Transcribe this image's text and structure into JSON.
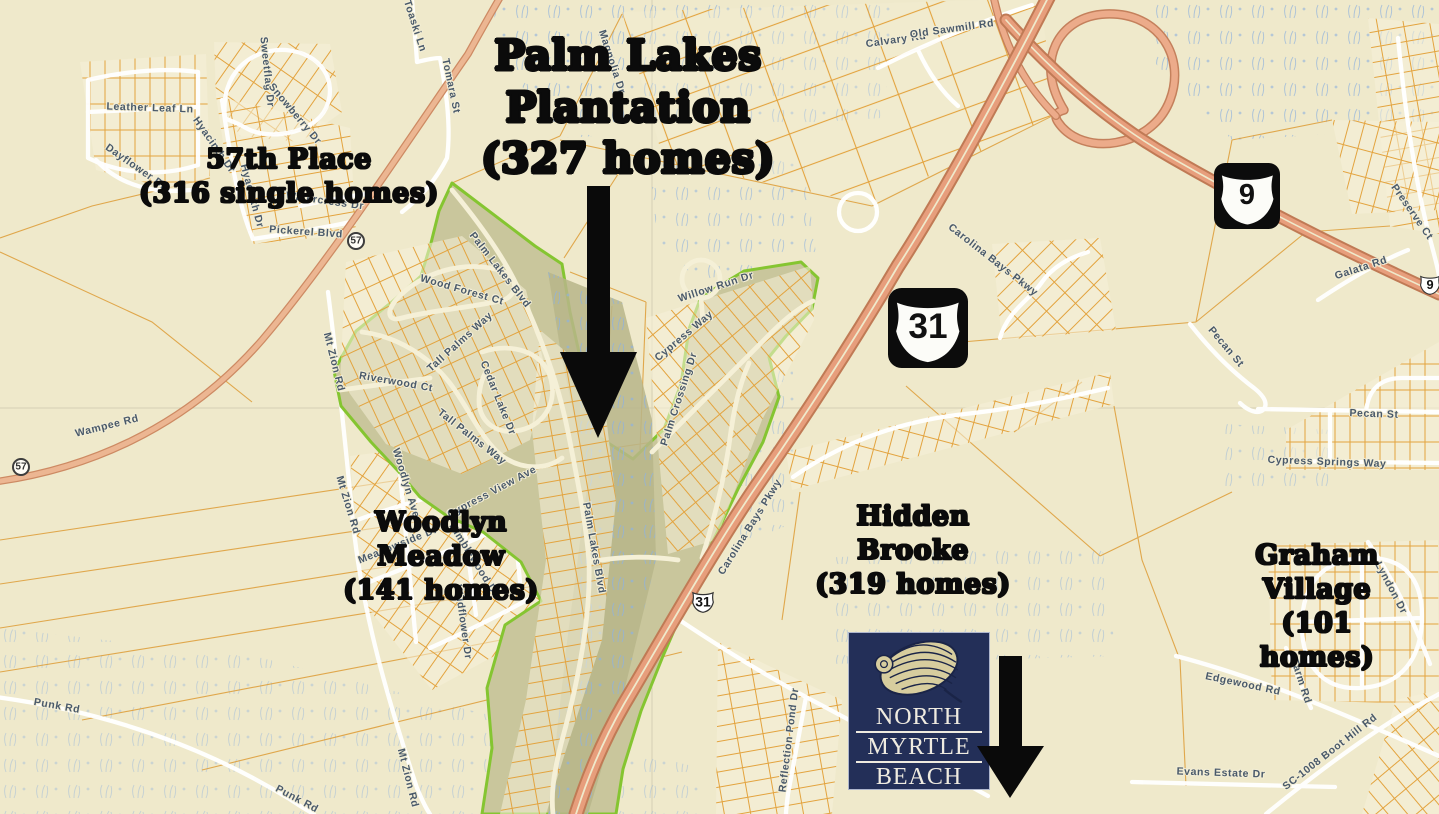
{
  "map": {
    "background_color": "#efe9cb",
    "parcel_line_color": "#dd9b35",
    "highway_color": "#e79e7c",
    "subdivision_fill": "#c9c69c",
    "subdivision_border_color": "#85c531",
    "marsh_mark_color": "#8fb2dd",
    "annotations": [
      {
        "id": "palm-lakes-plantation",
        "lines": [
          "Palm Lakes",
          "Plantation",
          "(327 homes)"
        ],
        "x": 628,
        "y": 108,
        "size": 41
      },
      {
        "id": "57th-place",
        "lines": [
          "57th Place",
          "(316 single homes)"
        ],
        "x": 289,
        "y": 177,
        "size": 27
      },
      {
        "id": "woodlyn-meadow",
        "lines": [
          "Woodlyn",
          "Meadow",
          "(141 homes)"
        ],
        "x": 441,
        "y": 557,
        "size": 27
      },
      {
        "id": "hidden-brooke",
        "lines": [
          "Hidden",
          "Brooke",
          "(319 homes)"
        ],
        "x": 913,
        "y": 551,
        "size": 27
      },
      {
        "id": "graham-village",
        "lines": [
          "Graham",
          "Village",
          "(101 homes)"
        ],
        "x": 1317,
        "y": 607,
        "size": 27
      }
    ],
    "street_labels": [
      {
        "text": "Toaski Ln",
        "x": 415,
        "y": 26,
        "rot": 72
      },
      {
        "text": "Tomara St",
        "x": 451,
        "y": 86,
        "rot": 78
      },
      {
        "text": "Magnolia Dr",
        "x": 612,
        "y": 62,
        "rot": 72
      },
      {
        "text": "Calvary Rd",
        "x": 896,
        "y": 40,
        "rot": -8
      },
      {
        "text": "Old Sawmill Rd",
        "x": 952,
        "y": 29,
        "rot": -8
      },
      {
        "text": "Leather Leaf Ln",
        "x": 150,
        "y": 108,
        "rot": 2
      },
      {
        "text": "Dayflower Dr",
        "x": 136,
        "y": 167,
        "rot": 35
      },
      {
        "text": "Hyacinth Dr",
        "x": 214,
        "y": 145,
        "rot": 55
      },
      {
        "text": "Hyacinth Dr",
        "x": 252,
        "y": 196,
        "rot": 75
      },
      {
        "text": "Sweetflag Dr",
        "x": 267,
        "y": 72,
        "rot": 84
      },
      {
        "text": "Snowberry Dr",
        "x": 295,
        "y": 114,
        "rot": 50
      },
      {
        "text": "Watercress Dr",
        "x": 325,
        "y": 201,
        "rot": 8
      },
      {
        "text": "Pickerel Blvd",
        "x": 306,
        "y": 232,
        "rot": 4
      },
      {
        "text": "Wampee Rd",
        "x": 107,
        "y": 426,
        "rot": -14
      },
      {
        "text": "Mt Zion Rd",
        "x": 334,
        "y": 362,
        "rot": 76
      },
      {
        "text": "Mt Zion Rd",
        "x": 348,
        "y": 505,
        "rot": 73
      },
      {
        "text": "Mt Zion Rd",
        "x": 408,
        "y": 778,
        "rot": 76
      },
      {
        "text": "Punk Rd",
        "x": 57,
        "y": 706,
        "rot": 10
      },
      {
        "text": "Punk Rd",
        "x": 297,
        "y": 799,
        "rot": 28
      },
      {
        "text": "Woodlyn Ave",
        "x": 406,
        "y": 483,
        "rot": 73
      },
      {
        "text": "Meadowside Dr",
        "x": 398,
        "y": 545,
        "rot": -22
      },
      {
        "text": "Cypress View Ave",
        "x": 492,
        "y": 492,
        "rot": -28
      },
      {
        "text": "Kimblewood Dr",
        "x": 474,
        "y": 560,
        "rot": 58
      },
      {
        "text": "Wildflower Dr",
        "x": 463,
        "y": 622,
        "rot": 82
      },
      {
        "text": "Palm Lakes Blvd",
        "x": 500,
        "y": 270,
        "rot": 52
      },
      {
        "text": "Palm Lakes Blvd",
        "x": 594,
        "y": 548,
        "rot": 80
      },
      {
        "text": "Wood Forest Ct",
        "x": 462,
        "y": 290,
        "rot": 16
      },
      {
        "text": "Tall Palms Way",
        "x": 460,
        "y": 342,
        "rot": -42
      },
      {
        "text": "Tall Palms Way",
        "x": 472,
        "y": 437,
        "rot": 38
      },
      {
        "text": "Riverwood Ct",
        "x": 396,
        "y": 382,
        "rot": 10
      },
      {
        "text": "Cedar Lake Dr",
        "x": 498,
        "y": 398,
        "rot": 68
      },
      {
        "text": "Cypress Way",
        "x": 684,
        "y": 336,
        "rot": -40
      },
      {
        "text": "Palm Crossing Dr",
        "x": 679,
        "y": 399,
        "rot": -72
      },
      {
        "text": "Willow Run Dr",
        "x": 716,
        "y": 287,
        "rot": -18
      },
      {
        "text": "Carolina Bays Pkwy",
        "x": 993,
        "y": 260,
        "rot": 38
      },
      {
        "text": "Carolina Bays Pkwy",
        "x": 750,
        "y": 527,
        "rot": -58
      },
      {
        "text": "Pecan St",
        "x": 1226,
        "y": 347,
        "rot": 50
      },
      {
        "text": "Pecan St",
        "x": 1374,
        "y": 414,
        "rot": 2
      },
      {
        "text": "Cypress Springs Way",
        "x": 1327,
        "y": 462,
        "rot": 2
      },
      {
        "text": "Preserve Ct",
        "x": 1412,
        "y": 212,
        "rot": 55
      },
      {
        "text": "Galata Rd",
        "x": 1361,
        "y": 268,
        "rot": -18
      },
      {
        "text": "Lyndon Dr",
        "x": 1391,
        "y": 588,
        "rot": 62
      },
      {
        "text": "Edgewood Rd",
        "x": 1243,
        "y": 684,
        "rot": 12
      },
      {
        "text": "Farm Rd",
        "x": 1301,
        "y": 681,
        "rot": 72
      },
      {
        "text": "Evans Estate Dr",
        "x": 1221,
        "y": 773,
        "rot": 2
      },
      {
        "text": "SC-1008 Boot Hill Rd",
        "x": 1330,
        "y": 752,
        "rot": -38
      },
      {
        "text": "Reflection Pond Dr",
        "x": 789,
        "y": 740,
        "rot": -83
      }
    ],
    "route_shields": {
      "us_large": [
        {
          "id": "us-31",
          "number": "31",
          "x": 928,
          "y": 328,
          "size": 80
        },
        {
          "id": "us-9",
          "number": "9",
          "x": 1247,
          "y": 196,
          "size": 66
        }
      ],
      "us_small": [
        {
          "id": "sc-31-marker",
          "number": "31",
          "x": 703,
          "y": 601,
          "size": 24
        },
        {
          "id": "sc-9-marker",
          "number": "9",
          "x": 1430,
          "y": 284,
          "size": 22
        }
      ],
      "circle": [
        {
          "id": "route-57-a",
          "number": "57",
          "x": 356,
          "y": 241,
          "size": 18
        },
        {
          "id": "route-57-b",
          "number": "57",
          "x": 21,
          "y": 467,
          "size": 18
        }
      ]
    }
  },
  "logo": {
    "line1": "NORTH",
    "line2": "MYRTLE",
    "line3": "BEACH",
    "bg_color": "#232f58",
    "text_color": "#efebe0",
    "shell_color": "#d7cd9e"
  }
}
